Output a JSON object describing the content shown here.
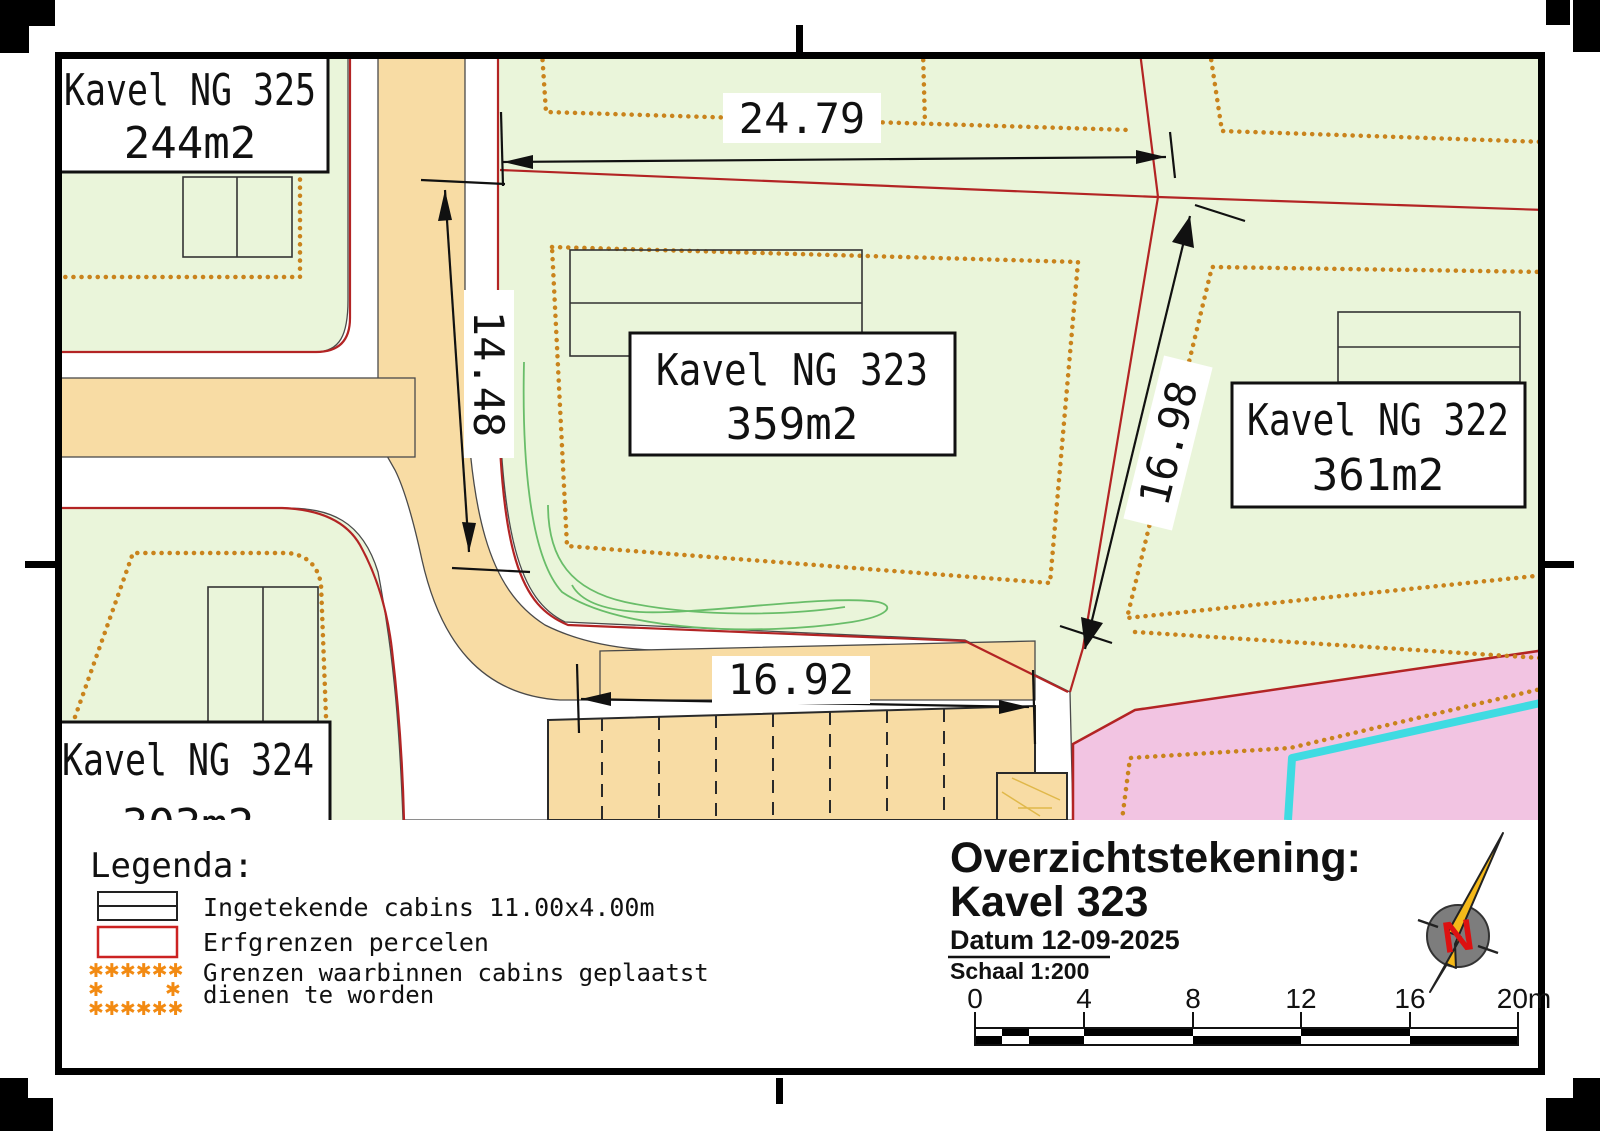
{
  "map": {
    "plot_labels": [
      {
        "name": "Kavel NG 325",
        "area": "244m2"
      },
      {
        "name": "Kavel NG 323",
        "area": "359m2"
      },
      {
        "name": "Kavel NG 322",
        "area": "361m2"
      },
      {
        "name": "Kavel NG 324",
        "area": "303m2"
      }
    ],
    "dimensions": [
      {
        "value": "24.79"
      },
      {
        "value": "14.48"
      },
      {
        "value": "16.98"
      },
      {
        "value": "16.92"
      }
    ],
    "colors": {
      "plot_green": "#eaf5da",
      "road_tan": "#f8dca4",
      "reserved_pink": "#f2c4e2",
      "waterline_cyan": "#3fdbe2",
      "parcel_boundary_red": "#b32424",
      "cabin_zone_orange": "#c9831c"
    }
  },
  "legend": {
    "title": "Legenda:",
    "items": [
      {
        "label": "Ingetekende cabins 11.00x4.00m"
      },
      {
        "label": "Erfgrenzen percelen"
      },
      {
        "label_line1": "Grenzen waarbinnen cabins geplaatst",
        "label_line2": "dienen te worden"
      }
    ],
    "star_rows": {
      "top": "✱✱✱✱✱✱",
      "mid_left": "✱",
      "mid_right": "✱",
      "bottom": "✱✱✱✱✱✱"
    },
    "star_color": "#f28a12"
  },
  "title_block": {
    "title_line1": "Overzichtstekening:",
    "title_line2": "Kavel 323",
    "date": "Datum 12-09-2025",
    "scale": "Schaal 1:200",
    "scale_color": "#cc1111"
  },
  "north_arrow": {
    "letter": "N"
  },
  "scale_bar": {
    "tick_labels": [
      "0",
      "4",
      "8",
      "12",
      "16",
      "20m"
    ]
  }
}
